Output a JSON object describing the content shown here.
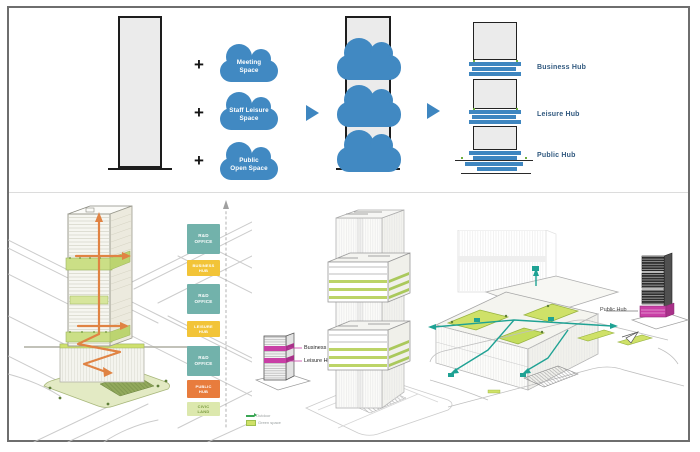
{
  "slide": {
    "top": {
      "plus_sign": "+",
      "clouds": [
        {
          "label": "Meeting\nSpace"
        },
        {
          "label": "Staff Leisure\nSpace"
        },
        {
          "label": "Public\nOpen Space"
        }
      ],
      "hub_labels": [
        "Business Hub",
        "Leisure Hub",
        "Public Hub"
      ]
    },
    "bottom": {
      "legend": [
        {
          "label": "R&D\nOFFICE",
          "color": "#72b2ab"
        },
        {
          "label": "BUSINESS\nHUB",
          "color": "#f2c438"
        },
        {
          "label": "R&D\nOFFICE",
          "color": "#72b2ab"
        },
        {
          "label": "LEISURE\nHUB",
          "color": "#f2c438"
        },
        {
          "label": "R&D\nOFFICE",
          "color": "#72b2ab"
        },
        {
          "label": "PUBLIC\nHUB",
          "color": "#e87c3d"
        },
        {
          "label": "CIVIC\nLAND",
          "color": "#dce8ad"
        }
      ],
      "key_tower_labels": [
        "Business Hub",
        "Leisure Hub"
      ],
      "public_hub_label": "Public Hub",
      "mini_legend": [
        {
          "label": "Outdoor"
        },
        {
          "label": "Green space"
        }
      ]
    },
    "colors": {
      "cloud_blue": "#4189c2",
      "slab_blue": "#3e86c0",
      "hub_label_blue": "#31597f",
      "legend_teal": "#72b2ab",
      "legend_yellow": "#f2c438",
      "legend_orange": "#e87c3d",
      "legend_light_green": "#dce8ad",
      "terrace_green": "#cbdf86",
      "route_orange": "#e08343",
      "magenta": "#c93fa6",
      "teal_path": "#1fa294"
    }
  }
}
